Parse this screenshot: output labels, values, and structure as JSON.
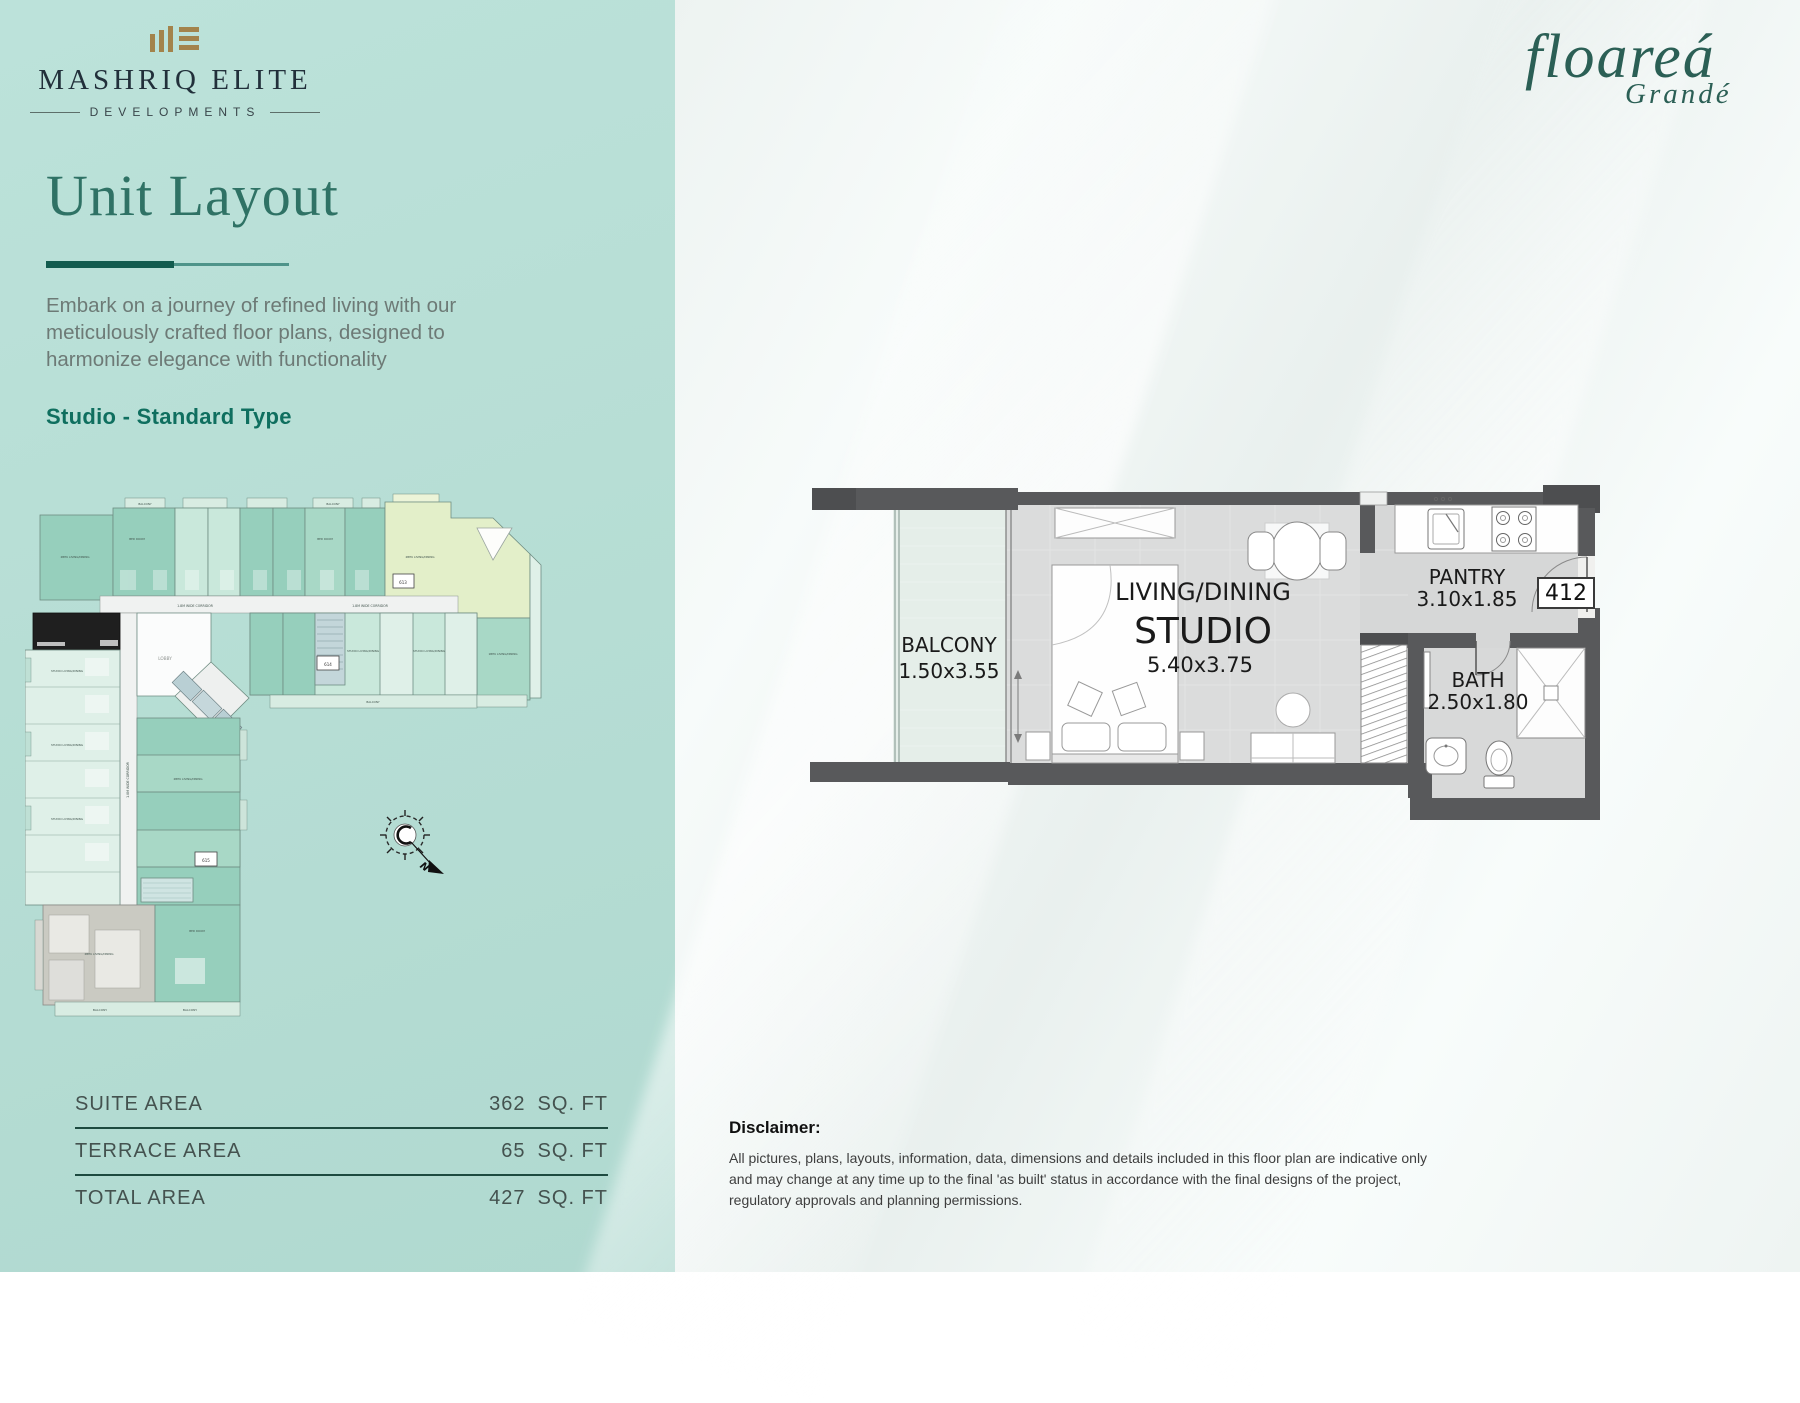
{
  "brand": {
    "logo_title": "MASHRIQ ELITE",
    "logo_subtitle": "DEVELOPMENTS",
    "project_logo": "floareá",
    "project_logo_sub": "Grandé"
  },
  "page": {
    "title": "Unit Layout",
    "description": "Embark on a journey of refined living with our meticulously crafted floor plans, designed to harmonize elegance with functionality",
    "unit_type": "Studio - Standard Type"
  },
  "areas": {
    "rows": [
      {
        "label": "SUITE AREA",
        "value": "362",
        "unit": "SQ. FT"
      },
      {
        "label": "TERRACE AREA",
        "value": "65",
        "unit": "SQ. FT"
      },
      {
        "label": "TOTAL AREA",
        "value": "427",
        "unit": "SQ. FT"
      }
    ]
  },
  "unit_plan": {
    "balcony_label": "BALCONY",
    "balcony_dim": "1.50x3.55",
    "living_label": "LIVING/DINING",
    "studio_label": "STUDIO",
    "studio_dim": "5.40x3.75",
    "pantry_label": "PANTRY",
    "pantry_dim": "3.10x1.85",
    "unit_number": "412",
    "bath_label": "BATH",
    "bath_dim": "2.50x1.80"
  },
  "key_plan": {
    "corridor_label": "1.8M WIDE CORRIDOR",
    "lobby_label": "LOBBY",
    "balcony_label": "BALCONY",
    "studio_label": "STUDIO LIVING/DINING",
    "bhk1_label": "1BHK LIVING/DINING",
    "bhk2_label": "2BHK LIVING/DINING",
    "bedroom_label": "BED ROOM",
    "north_label": "N",
    "unit_613": "613",
    "unit_614": "614",
    "unit_615": "615"
  },
  "disclaimer": {
    "title": "Disclaimer:",
    "body": "All pictures, plans, layouts, information, data, dimensions and details included in this floor plan are indicative only and may change at any time up to the final 'as built' status in accordance with the final designs of the project, regulatory approvals and planning permissions."
  },
  "colors": {
    "panel_teal": "#b7ded5",
    "accent_teal": "#0f6f5f",
    "logo_gold": "#a3834b",
    "plan_wall": "#58595b"
  }
}
